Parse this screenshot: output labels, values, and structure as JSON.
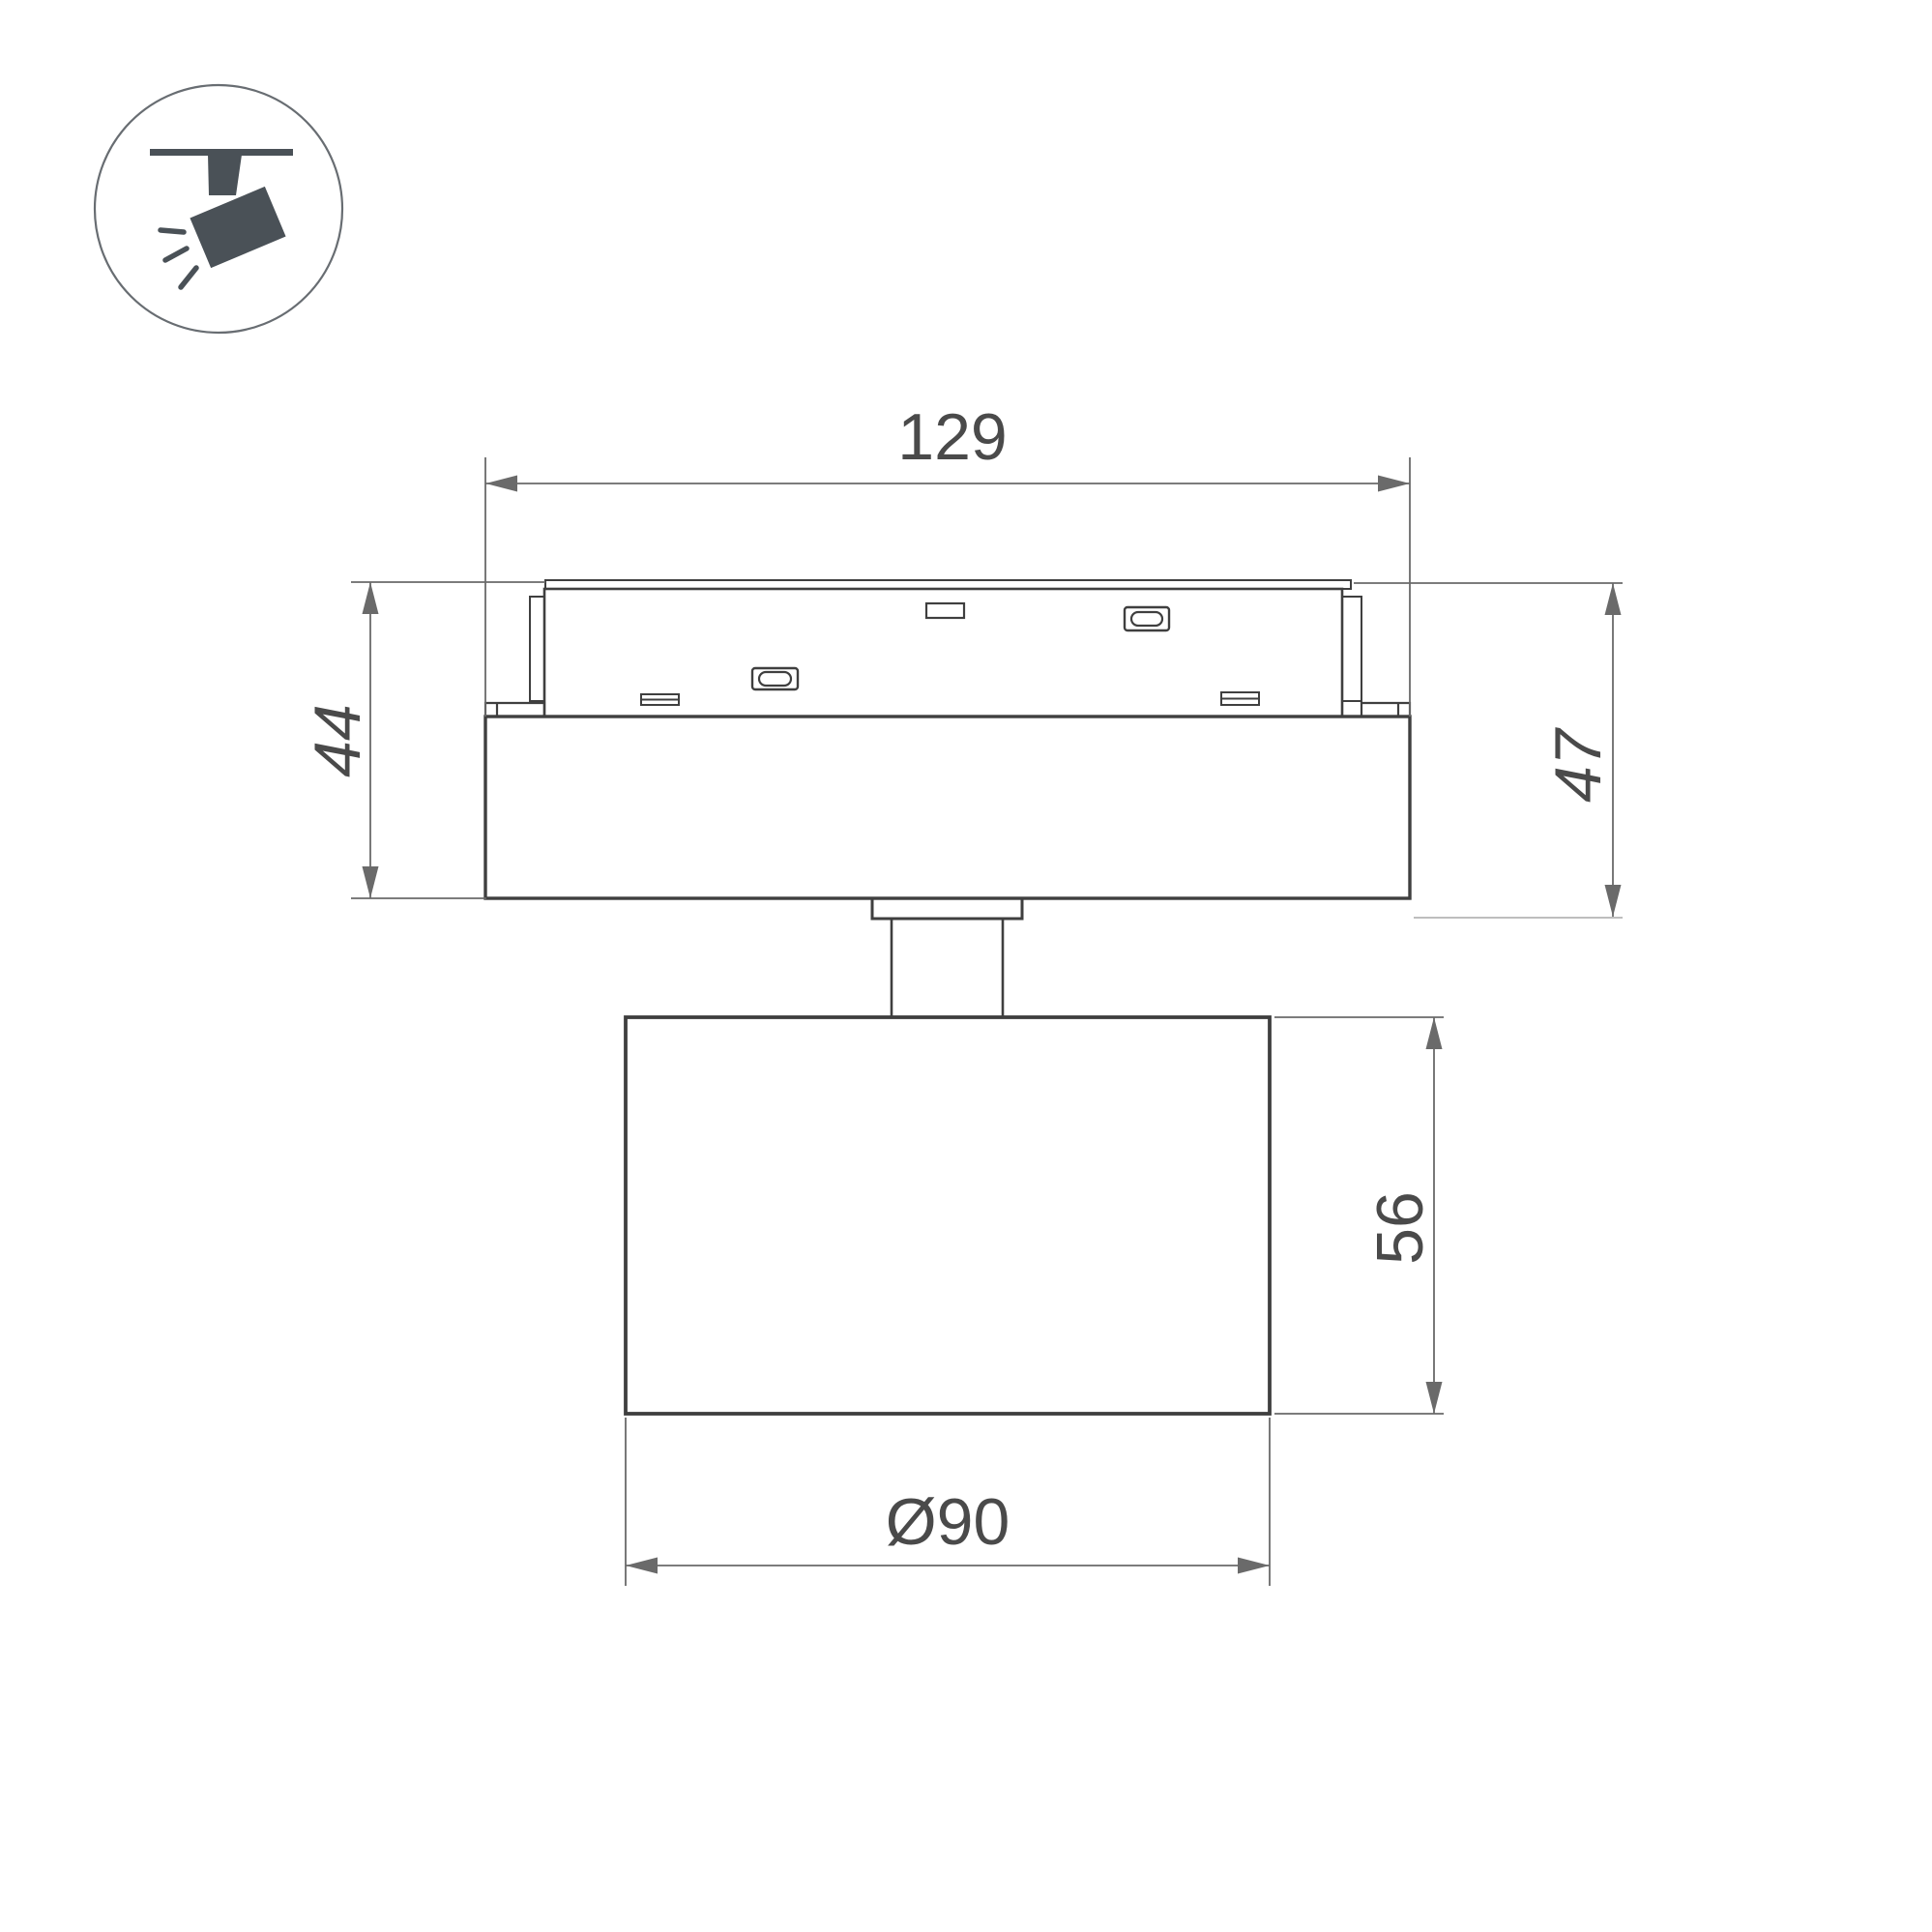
{
  "drawing": {
    "kind": "technical-dimension-drawing",
    "subject": "magnetic-track-spotlight-side-view"
  },
  "icon_badge": {
    "name": "track-spotlight-icon",
    "parts": [
      "track-bar",
      "stem",
      "tilted-head",
      "light-rays"
    ]
  },
  "dimensions": {
    "track_width": {
      "label": "129"
    },
    "adapter_height_left": {
      "label": "44"
    },
    "adapter_height_right": {
      "label": "47"
    },
    "head_height": {
      "label": "56"
    },
    "head_diameter": {
      "label": "Ø90"
    }
  },
  "colors": {
    "bg_color": "#ffffff",
    "line_color": "#3f3f3f",
    "dim_color": "#6a6a6a",
    "light_ext_color": "#b5b5b5",
    "text_color": "#4a4a4a",
    "icon_glyph_color": "#4a5157",
    "icon_ring_color": "#686d72"
  }
}
